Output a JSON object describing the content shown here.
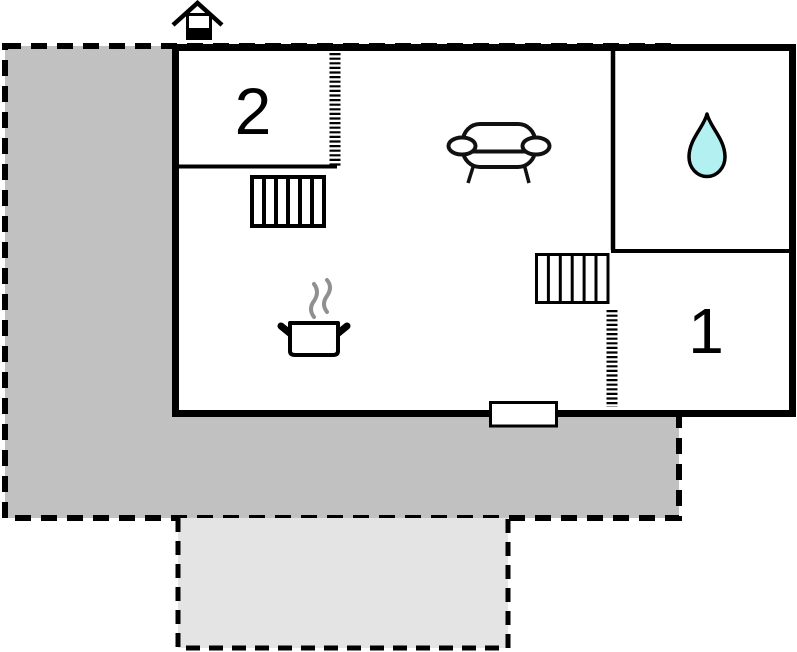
{
  "plan": {
    "type": "floor-plan",
    "rooms": {
      "room2": {
        "label": "2"
      },
      "room1": {
        "label": "1"
      }
    },
    "colors": {
      "background": "#ffffff",
      "wall": "#000000",
      "terrace_dark": "#c1c1c1",
      "terrace_light": "#e4e4e4",
      "water_drop": "#b3f0f2",
      "steam": "#909090",
      "furniture_outline": "#111111"
    },
    "icons": {
      "chimney": "chimney-icon",
      "sofa": "sofa-icon",
      "water_drop": "water-drop-icon",
      "cooking_pot": "cooking-pot-icon",
      "steam": "steam-icon",
      "staircase_upper": "staircase-icon",
      "staircase_lower": "staircase-icon",
      "entrance_step": "entrance-step",
      "door_opening": "door-opening-hatch"
    }
  }
}
